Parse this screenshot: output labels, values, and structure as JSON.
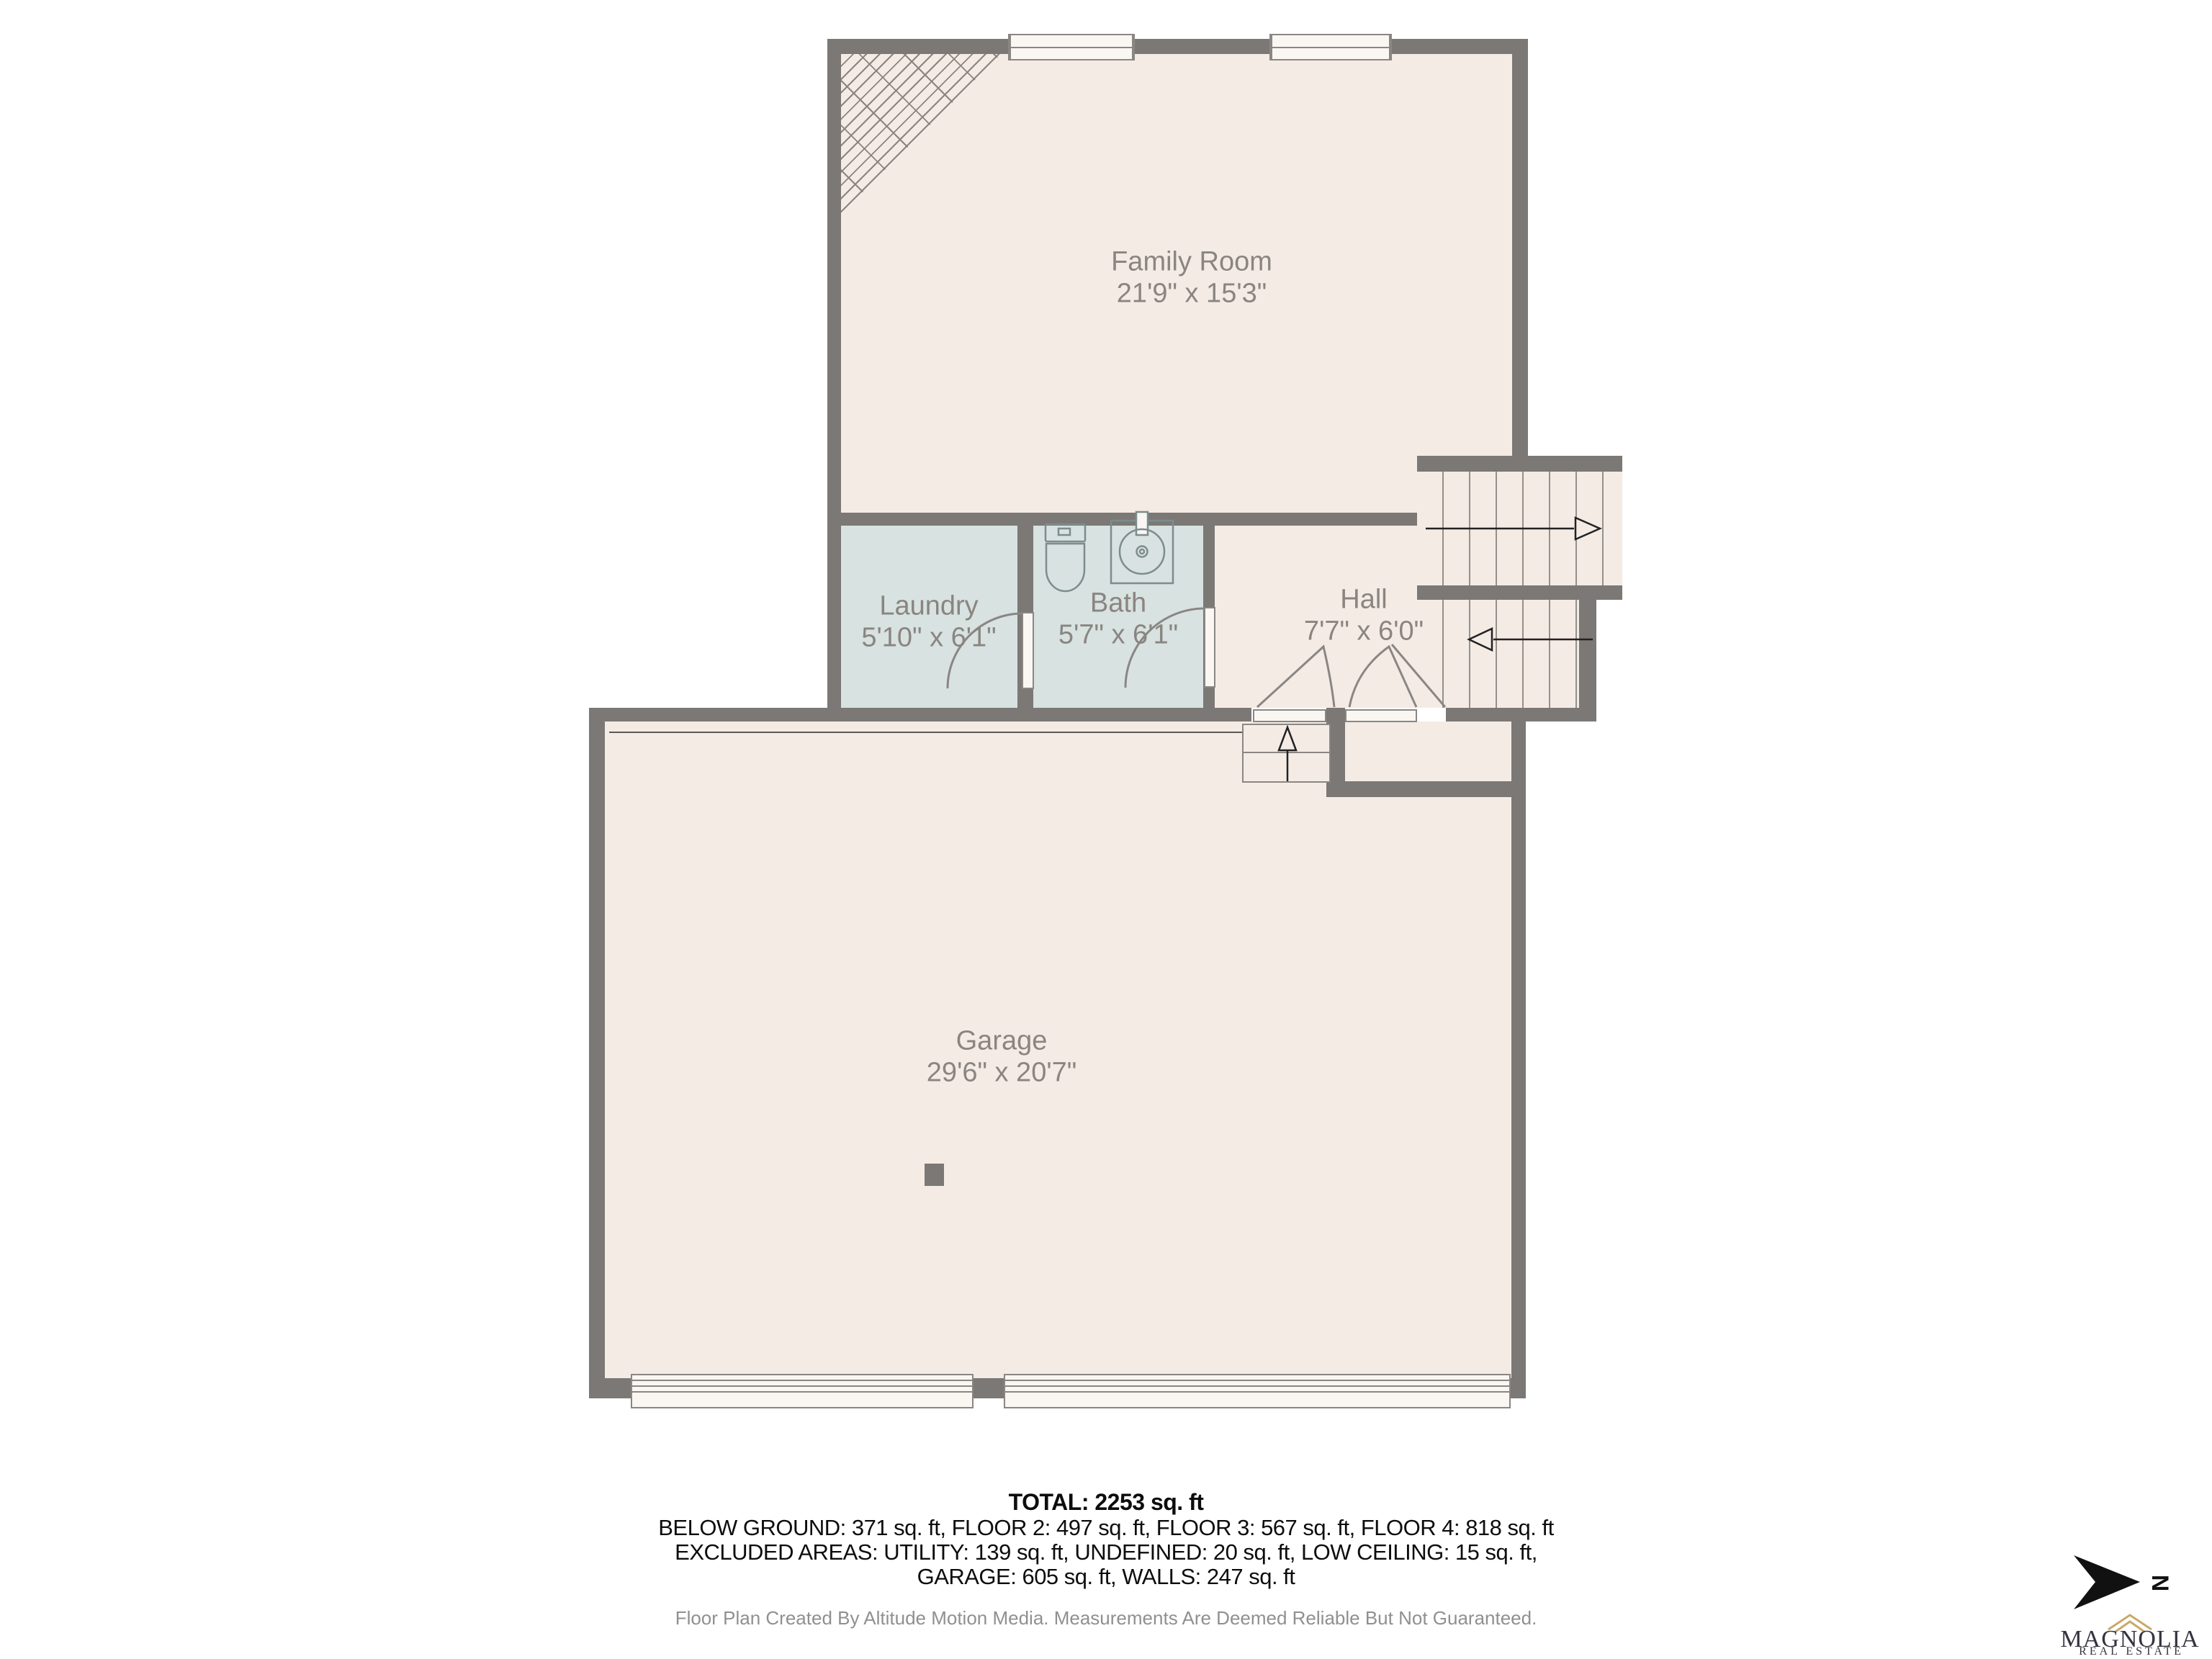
{
  "plan": {
    "rooms": [
      {
        "id": "family_room",
        "name": "Family Room",
        "dims": "21'9\" x 15'3\""
      },
      {
        "id": "laundry",
        "name": "Laundry",
        "dims": "5'10\" x 6'1\""
      },
      {
        "id": "bath",
        "name": "Bath",
        "dims": "5'7\" x 6'1\""
      },
      {
        "id": "hall",
        "name": "Hall",
        "dims": "7'7\" x 6'0\""
      },
      {
        "id": "garage",
        "name": "Garage",
        "dims": "29'6\" x 20'7\""
      }
    ]
  },
  "summary": {
    "total_line": "TOTAL: 2253 sq. ft",
    "floors_line": "BELOW GROUND: 371 sq. ft, FLOOR 2: 497 sq. ft, FLOOR 3: 567 sq. ft, FLOOR 4: 818 sq. ft",
    "excluded_line": "EXCLUDED AREAS: UTILITY: 139 sq. ft, UNDEFINED: 20 sq. ft, LOW CEILING: 15 sq. ft,",
    "garage_walls_line": "GARAGE: 605 sq. ft, WALLS: 247 sq. ft"
  },
  "footer": {
    "credit_line": "Floor Plan Created By Altitude Motion Media. Measurements Are Deemed Reliable But Not Guaranteed."
  },
  "compass": {
    "north_label": "N"
  },
  "branding": {
    "name": "MAGNOLIA",
    "tagline": "REAL ESTATE"
  },
  "colors": {
    "wall": "#7b7875",
    "room_fill": "#f4ebe5",
    "wet_room_fill": "#d7e2e1",
    "label_text": "#8a8580",
    "logo_gold": "#c9a96a"
  }
}
